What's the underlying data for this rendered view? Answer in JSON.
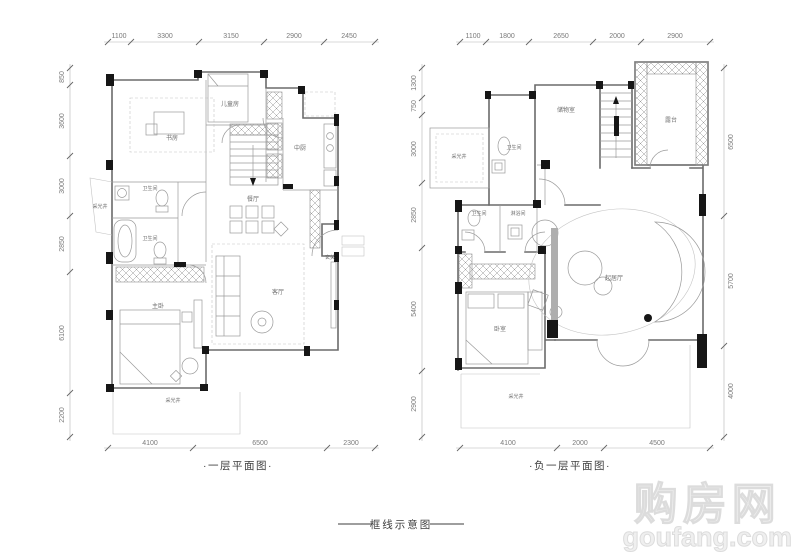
{
  "plans": [
    {
      "id": "first-floor",
      "caption": "·一层平面图·",
      "dims": {
        "top": [
          "1100",
          "3300",
          "3150",
          "2900",
          "2450"
        ],
        "left": [
          "850",
          "3600",
          "3000",
          "2850",
          "6100",
          "2200"
        ],
        "bottom": [
          "4100",
          "6500",
          "2300"
        ]
      },
      "rooms": {
        "study": "书房",
        "kids": "儿童房",
        "kitchen": "中厨",
        "bath_upper": "卫生间",
        "bath_lower": "卫生间",
        "lightwell_left": "采光井",
        "dining": "餐厅",
        "foyer": "玄关",
        "living": "客厅",
        "master": "主卧",
        "lightwell_bottom": "采光井"
      }
    },
    {
      "id": "basement",
      "caption": "·负一层平面图·",
      "dims": {
        "top": [
          "1100",
          "1800",
          "2650",
          "2000",
          "2900"
        ],
        "left": [
          "1300",
          "750",
          "3000",
          "2850",
          "5400",
          "2900"
        ],
        "right": [
          "6500",
          "5700",
          "4000"
        ],
        "bottom": [
          "4100",
          "2000",
          "4500"
        ]
      },
      "rooms": {
        "lightwell_top": "采光井",
        "storage": "储物室",
        "terrace": "露台",
        "bath_upper": "卫生间",
        "bath_lower": "卫生间",
        "shower": "淋浴间",
        "bedroom": "卧室",
        "family": "起居厅",
        "lightwell_bottom": "采光井"
      }
    }
  ],
  "footer": {
    "caption": "框线示意图"
  },
  "watermark": {
    "cn": "购房网",
    "site": "goufang.com"
  }
}
